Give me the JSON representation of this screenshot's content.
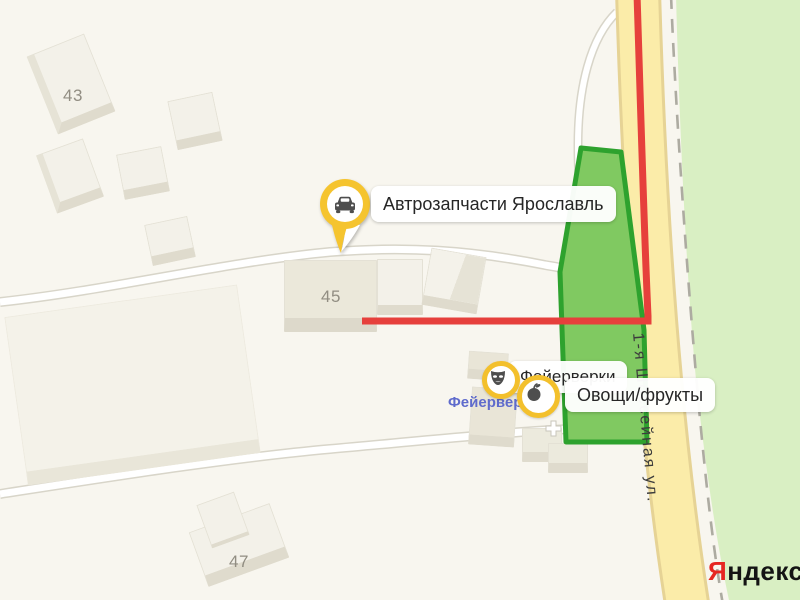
{
  "map": {
    "street_label": "1-я Шоссейная ул.",
    "store_label_blue": "Фейерверки",
    "colors": {
      "background": "#f8f6ef",
      "vegetation": "#d9efc3",
      "road_yellow": "#fbeca9",
      "road_yellow_casing": "#e6d395",
      "road_white_casing": "#d8d5c9",
      "route_red": "#e6403c",
      "selection_fill": "#80c961",
      "selection_stroke": "#2ea22e",
      "pin_yellow": "#f5c42f",
      "icon_gray": "#4e4e4e"
    }
  },
  "pois": {
    "auto_parts": {
      "label": "Автрозапчасти Ярославль",
      "icon": "car-icon"
    },
    "fireworks": {
      "label": "Фейерверки",
      "icon": "theater-mask-icon"
    },
    "produce": {
      "label": "Овощи/фрукты",
      "icon": "apple-icon"
    }
  },
  "buildings": [
    {
      "number": "43"
    },
    {
      "number": "45"
    },
    {
      "number": "47"
    }
  ],
  "logo": {
    "first_letter": "Я",
    "rest": "ндекс"
  }
}
